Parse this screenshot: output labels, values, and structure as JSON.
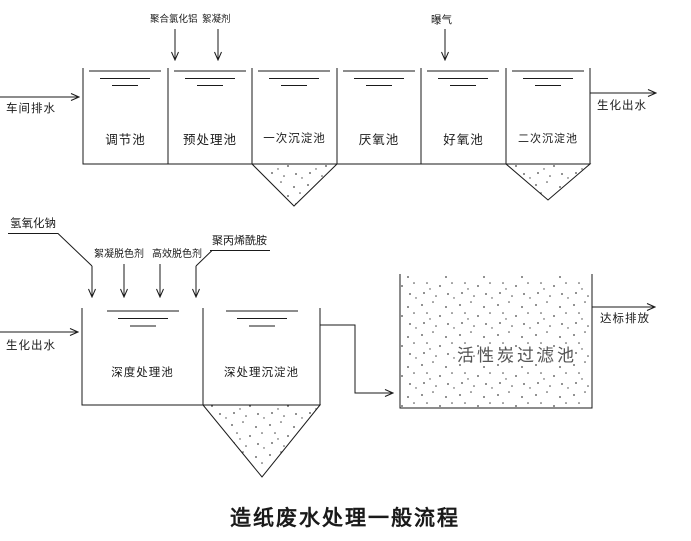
{
  "title": "造纸废水处理一般流程",
  "stage1": {
    "influent_label": "车间排水",
    "effluent_label": "生化出水",
    "chemicals": [
      "聚合氯化铝",
      "絮凝剂",
      "曝气"
    ],
    "tanks": [
      "调节池",
      "预处理池",
      "一次沉淀池",
      "厌氧池",
      "好氧池",
      "二次沉淀池"
    ]
  },
  "stage2": {
    "influent_label": "生化出水",
    "effluent_label": "达标排放",
    "chemicals": [
      "氢氧化钠",
      "絮凝脱色剂",
      "高效脱色剂",
      "聚丙烯酰胺"
    ],
    "tanks": [
      "深度处理池",
      "深处理沉淀池"
    ],
    "filter_tank_label": "活性炭过滤池"
  },
  "colors": {
    "line": "#1a1a1a",
    "background": "#ffffff",
    "stipple": "#444444",
    "filter_label": "#555555"
  }
}
